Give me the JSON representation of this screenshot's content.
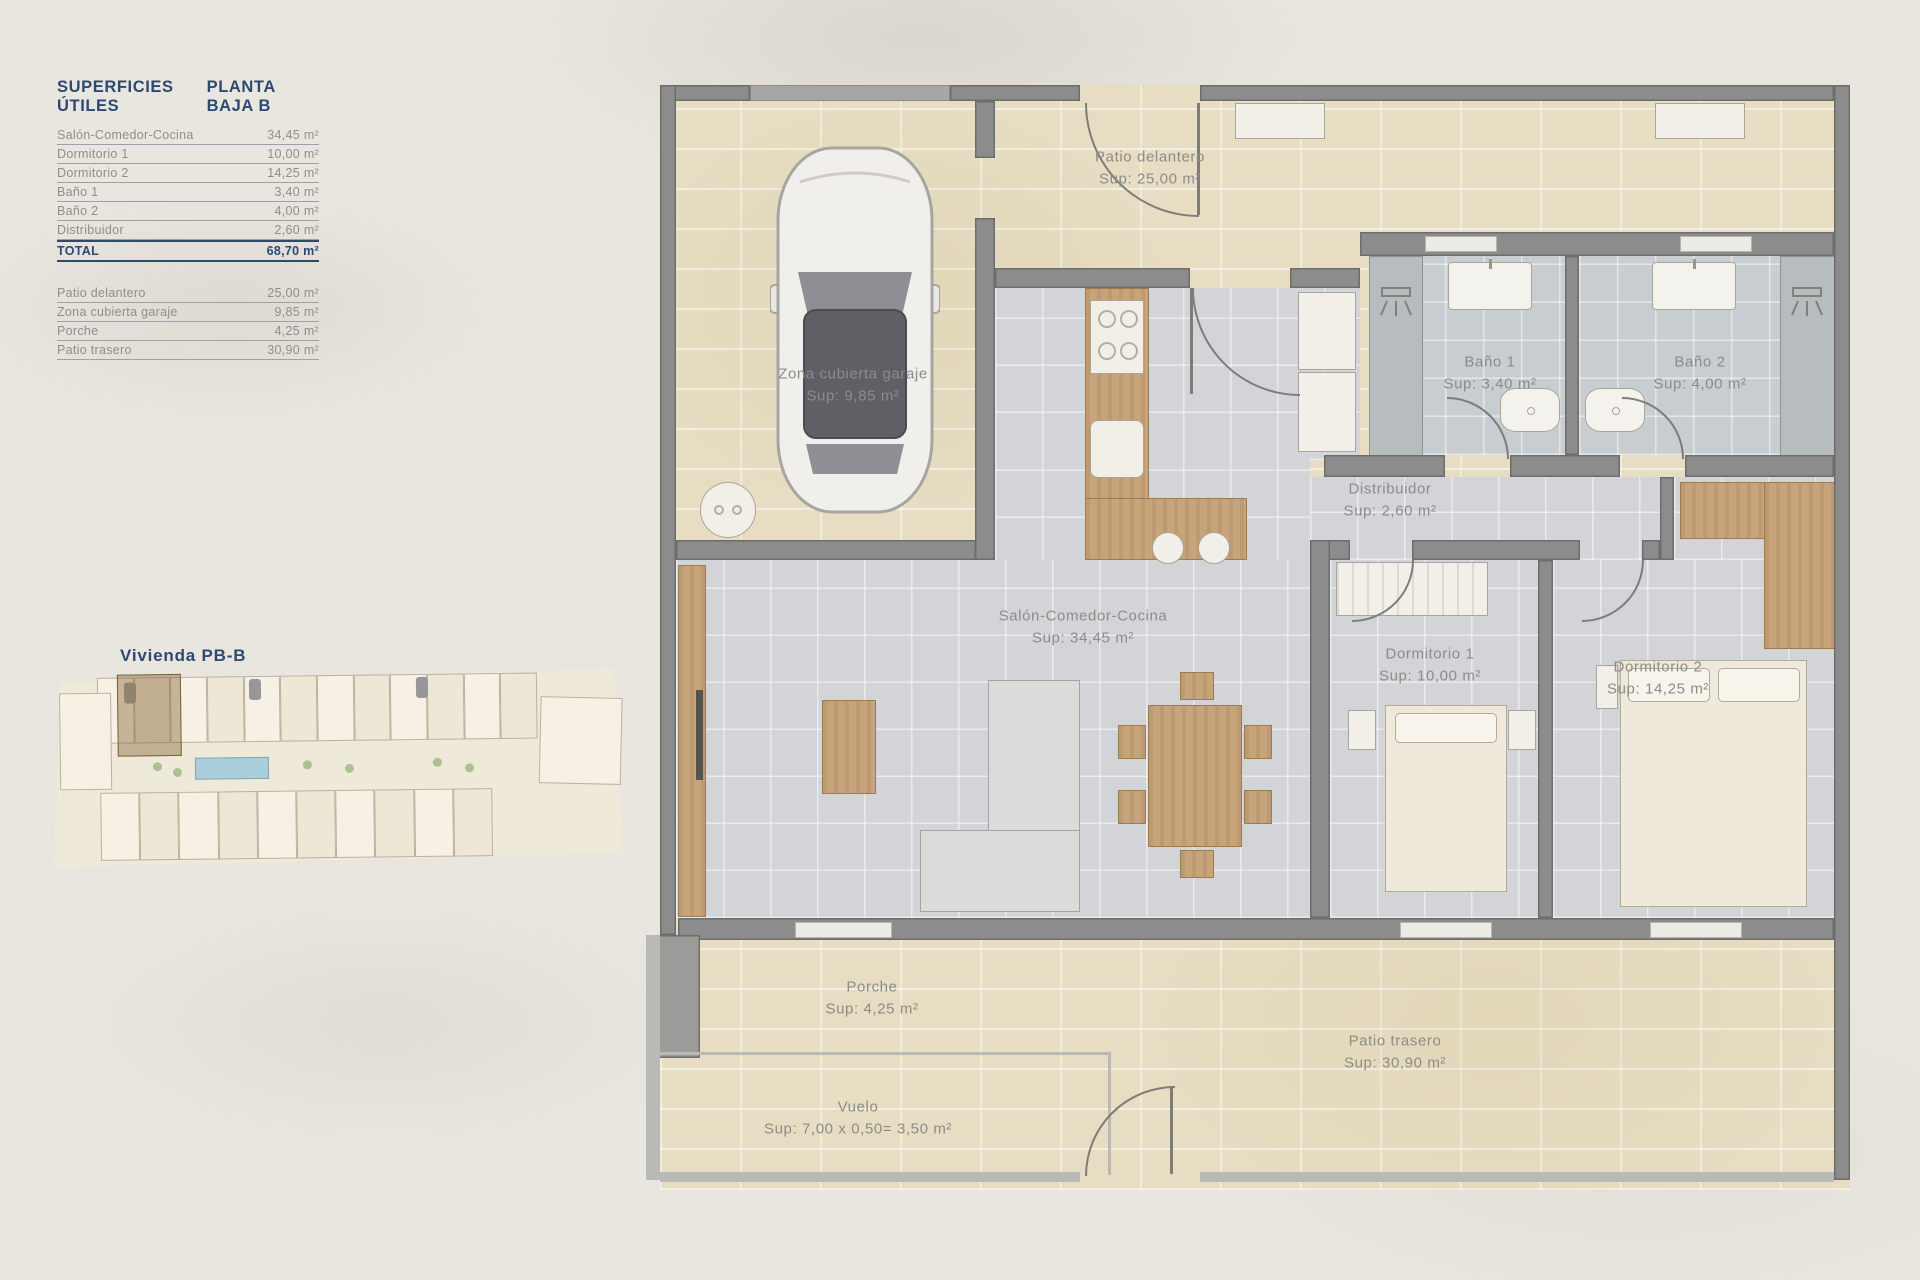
{
  "colors": {
    "accent_navy": "#2c4a70",
    "page_bg": "#e9e6e0",
    "patio_tile": "#e6ddc2",
    "interior_tile": "#d3d4d7",
    "bath_tile": "#c7cdd1",
    "wall_gray": "#8c8c8c",
    "wood": "#c8a47b",
    "label_gray": "#8c8c88"
  },
  "table": {
    "title": "SUPERFICIES ÚTILES",
    "subtitle": "PLANTA BAJA B",
    "rows": [
      {
        "label": "Salón-Comedor-Cocina",
        "value": "34,45 m²"
      },
      {
        "label": "Dormitorio 1",
        "value": "10,00 m²"
      },
      {
        "label": "Dormitorio 2",
        "value": "14,25 m²"
      },
      {
        "label": "Baño 1",
        "value": "3,40 m²"
      },
      {
        "label": "Baño 2",
        "value": "4,00 m²"
      },
      {
        "label": "Distribuidor",
        "value": "2,60 m²"
      }
    ],
    "total": {
      "label": "TOTAL",
      "value": "68,70 m²"
    },
    "extra": [
      {
        "label": "Patio delantero",
        "value": "25,00 m²"
      },
      {
        "label": "Zona cubierta garaje",
        "value": "9,85 m²"
      },
      {
        "label": "Porche",
        "value": "4,25 m²"
      },
      {
        "label": "Patio trasero",
        "value": "30,90 m²"
      }
    ]
  },
  "site_plan": {
    "title": "Vivienda PB-B"
  },
  "floor_plan": {
    "rooms": [
      {
        "name": "Patio delantero",
        "sup": "Sup: 25,00 m²"
      },
      {
        "name": "Zona cubierta garaje",
        "sup": "Sup: 9,85 m²"
      },
      {
        "name": "Baño 1",
        "sup": "Sup: 3,40 m²"
      },
      {
        "name": "Baño 2",
        "sup": "Sup: 4,00 m²"
      },
      {
        "name": "Distribuidor",
        "sup": "Sup: 2,60 m²"
      },
      {
        "name": "Salón-Comedor-Cocina",
        "sup": "Sup: 34,45 m²"
      },
      {
        "name": "Dormitorio 1",
        "sup": "Sup: 10,00 m²"
      },
      {
        "name": "Dormitorio 2",
        "sup": "Sup: 14,25 m²"
      },
      {
        "name": "Porche",
        "sup": "Sup: 4,25 m²"
      },
      {
        "name": "Patio trasero",
        "sup": "Sup: 30,90 m²"
      },
      {
        "name": "Vuelo",
        "sup": "Sup: 7,00 x 0,50= 3,50 m²"
      }
    ]
  }
}
